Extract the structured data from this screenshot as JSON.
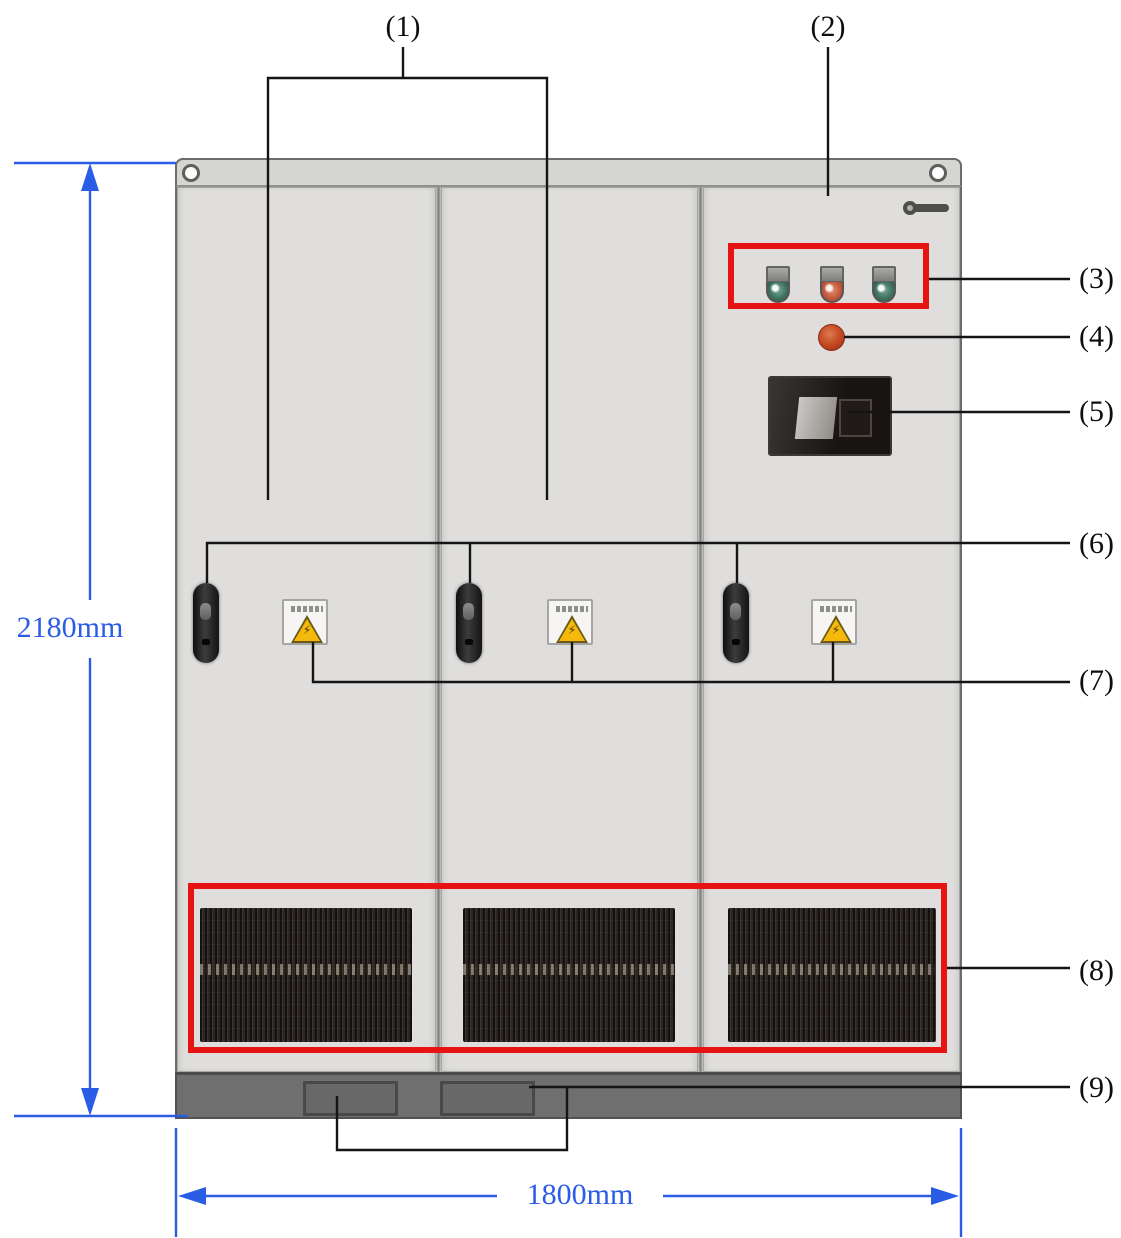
{
  "diagram": {
    "dimension_labels": {
      "height": "2180mm",
      "width": "1800mm"
    },
    "callout_labels": {
      "c1": "(1)",
      "c2": "(2)",
      "c3": "(3)",
      "c4": "(4)",
      "c5": "(5)",
      "c6": "(6)",
      "c7": "(7)",
      "c8": "(8)",
      "c9": "(9)"
    },
    "glyphs": {
      "warning_bolt": "⚡"
    },
    "colors": {
      "highlight_box_red": "#e81313",
      "dimension_blue": "#2b5ce6",
      "cabinet_gray": "#dedddb",
      "cabinet_top_gray": "#d5d5d2",
      "base_gray": "#6f6f6f",
      "grille_dark": "#2b2623",
      "warning_triangle_yellow": "#f4b90a",
      "emergency_stop_red": "#c24a22",
      "pilot_light_green": "#3f7362",
      "pilot_light_orange": "#c4593c",
      "handle_black": "#1c1c1c"
    }
  }
}
